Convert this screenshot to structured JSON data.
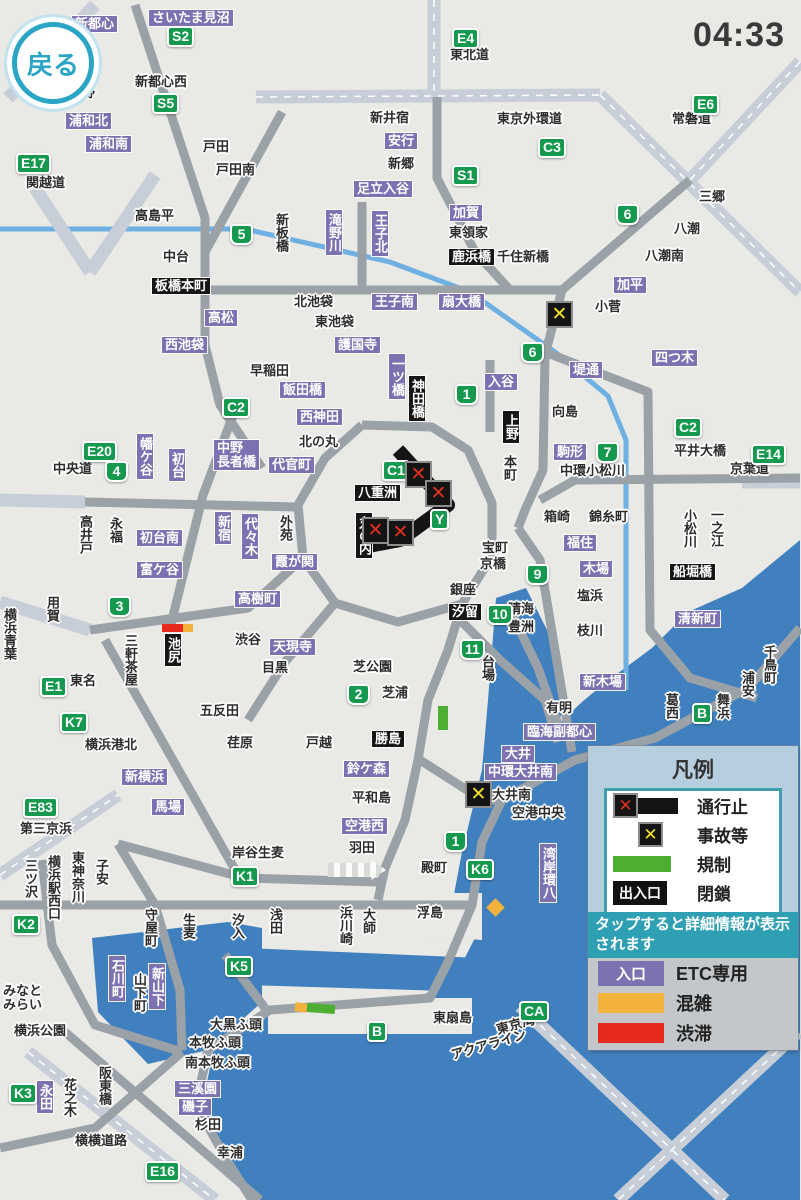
{
  "app": {
    "back_label": "戻る",
    "time": "04:33"
  },
  "colors": {
    "water": "#4180be",
    "land": "#e9e9e5",
    "road": "#9aa1a7",
    "road_light": "#c7ced8",
    "river": "#6fb0e2",
    "entrance": "#7e71b2",
    "route_badge": "#15994f",
    "jam": "#e62b1e",
    "congestion": "#f2b23c",
    "regulation": "#4caf32",
    "closed_road": "#141414"
  },
  "legend": {
    "title": "凡例",
    "rows": [
      {
        "sym": "closure",
        "label": "通行止"
      },
      {
        "sym": "accident",
        "label": "事故等"
      },
      {
        "sym": "regulation",
        "label": "規制"
      },
      {
        "sym": "gate",
        "badge": "出入口",
        "label": "閉鎖"
      }
    ],
    "note": "タップすると詳細情報が表示されます",
    "rows2": [
      {
        "sym": "entrance",
        "badge": "入口",
        "label": "ETC専用"
      },
      {
        "sym": "congestion",
        "label": "混雑"
      },
      {
        "sym": "jam",
        "label": "渋滞"
      }
    ]
  },
  "map": {
    "labels": [
      {
        "t": "さいたま見沼",
        "k": "e",
        "x": 149,
        "y": 10
      },
      {
        "t": "新都心",
        "k": "e",
        "x": 72,
        "y": 16
      },
      {
        "t": "S2",
        "k": "r",
        "x": 167,
        "y": 26
      },
      {
        "t": "野",
        "k": "p",
        "x": 82,
        "y": 86
      },
      {
        "t": "新都心西",
        "k": "p",
        "x": 135,
        "y": 75
      },
      {
        "t": "S5",
        "k": "r",
        "x": 152,
        "y": 93
      },
      {
        "t": "浦和北",
        "k": "e",
        "x": 66,
        "y": 113
      },
      {
        "t": "浦和南",
        "k": "e",
        "x": 86,
        "y": 136
      },
      {
        "t": "E17",
        "k": "r",
        "x": 16,
        "y": 153
      },
      {
        "t": "関越道",
        "k": "p",
        "x": 26,
        "y": 176
      },
      {
        "t": "戸田",
        "k": "p",
        "x": 203,
        "y": 140
      },
      {
        "t": "戸田南",
        "k": "p",
        "x": 216,
        "y": 163
      },
      {
        "t": "E4",
        "k": "r",
        "x": 452,
        "y": 28
      },
      {
        "t": "東北道",
        "k": "p",
        "x": 450,
        "y": 48
      },
      {
        "t": "新井宿",
        "k": "p",
        "x": 370,
        "y": 111
      },
      {
        "t": "安行",
        "k": "e",
        "x": 385,
        "y": 133
      },
      {
        "t": "新郷",
        "k": "p",
        "x": 388,
        "y": 157
      },
      {
        "t": "足立入谷",
        "k": "e",
        "x": 354,
        "y": 181
      },
      {
        "t": "東京外環道",
        "k": "p",
        "x": 497,
        "y": 112
      },
      {
        "t": "C3",
        "k": "r",
        "x": 538,
        "y": 137
      },
      {
        "t": "E6",
        "k": "r",
        "x": 692,
        "y": 94
      },
      {
        "t": "常磐道",
        "k": "p",
        "x": 672,
        "y": 112
      },
      {
        "t": "S1",
        "k": "r",
        "x": 452,
        "y": 165
      },
      {
        "t": "三郷",
        "k": "p",
        "x": 699,
        "y": 190
      },
      {
        "t": "高島平",
        "k": "p",
        "x": 135,
        "y": 209
      },
      {
        "t": "中台",
        "k": "p",
        "x": 163,
        "y": 250
      },
      {
        "t": "5",
        "k": "n",
        "x": 230,
        "y": 224
      },
      {
        "t": "加賀",
        "k": "e",
        "x": 450,
        "y": 205
      },
      {
        "t": "東領家",
        "k": "p",
        "x": 449,
        "y": 226
      },
      {
        "t": "鹿浜橋",
        "k": "f",
        "x": 449,
        "y": 249
      },
      {
        "t": "千住新橋",
        "k": "p",
        "x": 497,
        "y": 250
      },
      {
        "t": "八潮",
        "k": "p",
        "x": 674,
        "y": 222
      },
      {
        "t": "八潮南",
        "k": "p",
        "x": 645,
        "y": 249
      },
      {
        "t": "6",
        "k": "n",
        "x": 616,
        "y": 204
      },
      {
        "t": "加平",
        "k": "e",
        "x": 614,
        "y": 277
      },
      {
        "t": "小菅",
        "k": "p",
        "x": 595,
        "y": 300
      },
      {
        "t": "新板橋",
        "k": "pv",
        "x": 274,
        "y": 213
      },
      {
        "t": "滝野川",
        "k": "ev",
        "x": 326,
        "y": 210
      },
      {
        "t": "王子北",
        "k": "ev",
        "x": 372,
        "y": 211
      },
      {
        "t": "板橋本町",
        "k": "f",
        "x": 152,
        "y": 278
      },
      {
        "t": "北池袋",
        "k": "p",
        "x": 294,
        "y": 295
      },
      {
        "t": "王子南",
        "k": "e",
        "x": 372,
        "y": 294
      },
      {
        "t": "扇大橋",
        "k": "e",
        "x": 439,
        "y": 294
      },
      {
        "t": "高松",
        "k": "e",
        "x": 205,
        "y": 310
      },
      {
        "t": "西池袋",
        "k": "e",
        "x": 162,
        "y": 337
      },
      {
        "t": "東池袋",
        "k": "p",
        "x": 315,
        "y": 315
      },
      {
        "t": "護国寺",
        "k": "e",
        "x": 335,
        "y": 337
      },
      {
        "t": "四つ木",
        "k": "e",
        "x": 652,
        "y": 350
      },
      {
        "t": "堤通",
        "k": "e",
        "x": 570,
        "y": 362
      },
      {
        "t": "6",
        "k": "n",
        "x": 521,
        "y": 342
      },
      {
        "t": "早稲田",
        "k": "p",
        "x": 250,
        "y": 364
      },
      {
        "t": "飯田橋",
        "k": "e",
        "x": 280,
        "y": 382
      },
      {
        "t": "西神田",
        "k": "e",
        "x": 297,
        "y": 409
      },
      {
        "t": "一ツ橋",
        "k": "ev",
        "x": 389,
        "y": 354
      },
      {
        "t": "神田橋",
        "k": "fv",
        "x": 409,
        "y": 376
      },
      {
        "t": "入谷",
        "k": "e",
        "x": 485,
        "y": 374
      },
      {
        "t": "1",
        "k": "n",
        "x": 455,
        "y": 384
      },
      {
        "t": "上野",
        "k": "fv",
        "x": 503,
        "y": 411
      },
      {
        "t": "本町",
        "k": "pv",
        "x": 502,
        "y": 455
      },
      {
        "t": "向島",
        "k": "p",
        "x": 552,
        "y": 405
      },
      {
        "t": "C2",
        "k": "r",
        "x": 222,
        "y": 397
      },
      {
        "t": "中野\n長者橋",
        "k": "e",
        "x": 214,
        "y": 440
      },
      {
        "t": "幡ケ谷",
        "k": "ev",
        "x": 137,
        "y": 434
      },
      {
        "t": "初台",
        "k": "ev",
        "x": 169,
        "y": 449
      },
      {
        "t": "E20",
        "k": "r",
        "x": 82,
        "y": 441
      },
      {
        "t": "中央道",
        "k": "p",
        "x": 53,
        "y": 462
      },
      {
        "t": "4",
        "k": "n",
        "x": 105,
        "y": 461
      },
      {
        "t": "北の丸",
        "k": "p",
        "x": 299,
        "y": 435
      },
      {
        "t": "代官町",
        "k": "e",
        "x": 269,
        "y": 457
      },
      {
        "t": "C1",
        "k": "r",
        "x": 382,
        "y": 460
      },
      {
        "t": "八重洲",
        "k": "f",
        "x": 355,
        "y": 485
      },
      {
        "t": "Y",
        "k": "r",
        "x": 430,
        "y": 509
      },
      {
        "t": "丸の内",
        "k": "fv",
        "x": 356,
        "y": 513
      },
      {
        "t": "駒形",
        "k": "e",
        "x": 554,
        "y": 444
      },
      {
        "t": "7",
        "k": "n",
        "x": 596,
        "y": 442
      },
      {
        "t": "中環小松川",
        "k": "p",
        "x": 560,
        "y": 464
      },
      {
        "t": "C2",
        "k": "r",
        "x": 674,
        "y": 417
      },
      {
        "t": "平井大橋",
        "k": "p",
        "x": 674,
        "y": 444
      },
      {
        "t": "E14",
        "k": "r",
        "x": 751,
        "y": 444
      },
      {
        "t": "京葉道",
        "k": "p",
        "x": 730,
        "y": 462
      },
      {
        "t": "高井戸",
        "k": "pv",
        "x": 78,
        "y": 515
      },
      {
        "t": "永福",
        "k": "pv",
        "x": 108,
        "y": 517
      },
      {
        "t": "新宿",
        "k": "ev",
        "x": 215,
        "y": 512
      },
      {
        "t": "代々木",
        "k": "ev",
        "x": 242,
        "y": 514
      },
      {
        "t": "初台南",
        "k": "e",
        "x": 137,
        "y": 530
      },
      {
        "t": "富ケ谷",
        "k": "e",
        "x": 137,
        "y": 562
      },
      {
        "t": "外苑",
        "k": "pv",
        "x": 278,
        "y": 515
      },
      {
        "t": "霞が関",
        "k": "e",
        "x": 272,
        "y": 554
      },
      {
        "t": "箱崎",
        "k": "p",
        "x": 544,
        "y": 510
      },
      {
        "t": "錦糸町",
        "k": "p",
        "x": 589,
        "y": 510
      },
      {
        "t": "小松川",
        "k": "pv",
        "x": 682,
        "y": 509
      },
      {
        "t": "一之江",
        "k": "pv",
        "x": 709,
        "y": 508
      },
      {
        "t": "船堀橋",
        "k": "f",
        "x": 670,
        "y": 564
      },
      {
        "t": "福住",
        "k": "e",
        "x": 564,
        "y": 535
      },
      {
        "t": "木場",
        "k": "e",
        "x": 580,
        "y": 561
      },
      {
        "t": "塩浜",
        "k": "p",
        "x": 577,
        "y": 589
      },
      {
        "t": "枝川",
        "k": "p",
        "x": 577,
        "y": 624
      },
      {
        "t": "宝町",
        "k": "p",
        "x": 482,
        "y": 541
      },
      {
        "t": "京橋",
        "k": "p",
        "x": 480,
        "y": 557
      },
      {
        "t": "銀座",
        "k": "p",
        "x": 450,
        "y": 583
      },
      {
        "t": "9",
        "k": "n",
        "x": 526,
        "y": 564
      },
      {
        "t": "汐留",
        "k": "f",
        "x": 449,
        "y": 604
      },
      {
        "t": "10",
        "k": "n",
        "x": 487,
        "y": 604
      },
      {
        "t": "晴海",
        "k": "p",
        "x": 508,
        "y": 602
      },
      {
        "t": "豊洲",
        "k": "p",
        "x": 508,
        "y": 620
      },
      {
        "t": "11",
        "k": "n",
        "x": 460,
        "y": 639
      },
      {
        "t": "台場",
        "k": "pv",
        "x": 480,
        "y": 655
      },
      {
        "t": "高樹町",
        "k": "e",
        "x": 235,
        "y": 591
      },
      {
        "t": "渋谷",
        "k": "p",
        "x": 235,
        "y": 633
      },
      {
        "t": "天現寺",
        "k": "e",
        "x": 270,
        "y": 639
      },
      {
        "t": "目黒",
        "k": "p",
        "x": 262,
        "y": 661
      },
      {
        "t": "池尻",
        "k": "fv",
        "x": 165,
        "y": 634
      },
      {
        "t": "3",
        "k": "n",
        "x": 108,
        "y": 596
      },
      {
        "t": "用賀",
        "k": "pv",
        "x": 45,
        "y": 596
      },
      {
        "t": "横浜青葉",
        "k": "pv",
        "x": 2,
        "y": 608
      },
      {
        "t": "三軒茶屋",
        "k": "pv",
        "x": 123,
        "y": 634
      },
      {
        "t": "E1",
        "k": "r",
        "x": 40,
        "y": 676
      },
      {
        "t": "東名",
        "k": "p",
        "x": 70,
        "y": 674
      },
      {
        "t": "五反田",
        "k": "p",
        "x": 200,
        "y": 704
      },
      {
        "t": "荏原",
        "k": "p",
        "x": 227,
        "y": 736
      },
      {
        "t": "芝公園",
        "k": "p",
        "x": 353,
        "y": 660
      },
      {
        "t": "2",
        "k": "n",
        "x": 347,
        "y": 684
      },
      {
        "t": "芝浦",
        "k": "p",
        "x": 382,
        "y": 686
      },
      {
        "t": "戸越",
        "k": "p",
        "x": 306,
        "y": 736
      },
      {
        "t": "勝島",
        "k": "f",
        "x": 372,
        "y": 731
      },
      {
        "t": "鈴ケ森",
        "k": "e",
        "x": 344,
        "y": 761
      },
      {
        "t": "K7",
        "k": "r",
        "x": 60,
        "y": 712
      },
      {
        "t": "横浜港北",
        "k": "p",
        "x": 85,
        "y": 738
      },
      {
        "t": "新横浜",
        "k": "e",
        "x": 122,
        "y": 769
      },
      {
        "t": "馬場",
        "k": "e",
        "x": 152,
        "y": 799
      },
      {
        "t": "E83",
        "k": "r",
        "x": 23,
        "y": 797
      },
      {
        "t": "第三京浜",
        "k": "p",
        "x": 20,
        "y": 822
      },
      {
        "t": "新木場",
        "k": "e",
        "x": 580,
        "y": 674
      },
      {
        "t": "有明",
        "k": "p",
        "x": 546,
        "y": 701
      },
      {
        "t": "臨海副都心",
        "k": "e",
        "x": 524,
        "y": 724
      },
      {
        "t": "葛西",
        "k": "pv",
        "x": 664,
        "y": 693
      },
      {
        "t": "B",
        "k": "r",
        "x": 692,
        "y": 703
      },
      {
        "t": "舞浜",
        "k": "pv",
        "x": 715,
        "y": 693
      },
      {
        "t": "浦安",
        "k": "pv",
        "x": 740,
        "y": 671
      },
      {
        "t": "千鳥町",
        "k": "pv",
        "x": 762,
        "y": 645
      },
      {
        "t": "清新町",
        "k": "e",
        "x": 675,
        "y": 611
      },
      {
        "t": "大井",
        "k": "e",
        "x": 502,
        "y": 746
      },
      {
        "t": "中環大井南",
        "k": "e",
        "x": 485,
        "y": 764
      },
      {
        "t": "大井南",
        "k": "p",
        "x": 492,
        "y": 788
      },
      {
        "t": "空港中央",
        "k": "p",
        "x": 512,
        "y": 806
      },
      {
        "t": "平和島",
        "k": "p",
        "x": 352,
        "y": 791
      },
      {
        "t": "空港西",
        "k": "e",
        "x": 342,
        "y": 818
      },
      {
        "t": "羽田",
        "k": "p",
        "x": 349,
        "y": 841
      },
      {
        "t": "1",
        "k": "n",
        "x": 444,
        "y": 831
      },
      {
        "t": "殿町",
        "k": "p",
        "x": 421,
        "y": 861
      },
      {
        "t": "K6",
        "k": "r",
        "x": 466,
        "y": 859
      },
      {
        "t": "湾岸環八",
        "k": "ev",
        "x": 540,
        "y": 844
      },
      {
        "t": "岸谷生麦",
        "k": "p",
        "x": 232,
        "y": 846
      },
      {
        "t": "K1",
        "k": "r",
        "x": 231,
        "y": 866
      },
      {
        "t": "浮島",
        "k": "p",
        "x": 417,
        "y": 906
      },
      {
        "t": "浅田",
        "k": "pv",
        "x": 268,
        "y": 908
      },
      {
        "t": "浜川崎",
        "k": "pv",
        "x": 338,
        "y": 906
      },
      {
        "t": "大師",
        "k": "pv",
        "x": 361,
        "y": 908
      },
      {
        "t": "三ツ沢",
        "k": "pv",
        "x": 23,
        "y": 859
      },
      {
        "t": "横浜駅西口",
        "k": "pv",
        "x": 46,
        "y": 855
      },
      {
        "t": "東神奈川",
        "k": "pv",
        "x": 70,
        "y": 851
      },
      {
        "t": "子安",
        "k": "pv",
        "x": 94,
        "y": 859
      },
      {
        "t": "K2",
        "k": "r",
        "x": 12,
        "y": 914
      },
      {
        "t": "守屋町",
        "k": "pv",
        "x": 143,
        "y": 908
      },
      {
        "t": "生麦",
        "k": "pv",
        "x": 181,
        "y": 913
      },
      {
        "t": "汐入",
        "k": "pv",
        "x": 230,
        "y": 913
      },
      {
        "t": "K5",
        "k": "r",
        "x": 225,
        "y": 956
      },
      {
        "t": "石川町",
        "k": "ev",
        "x": 109,
        "y": 956
      },
      {
        "t": "山下町",
        "k": "pv",
        "x": 132,
        "y": 973
      },
      {
        "t": "新山下",
        "k": "ev",
        "x": 149,
        "y": 964
      },
      {
        "t": "みなと\nみらい",
        "k": "p",
        "x": 3,
        "y": 984
      },
      {
        "t": "横浜公園",
        "k": "p",
        "x": 14,
        "y": 1024
      },
      {
        "t": "K3",
        "k": "r",
        "x": 9,
        "y": 1083
      },
      {
        "t": "永田",
        "k": "ev",
        "x": 37,
        "y": 1081
      },
      {
        "t": "花之木",
        "k": "pv",
        "x": 62,
        "y": 1078
      },
      {
        "t": "阪東橋",
        "k": "pv",
        "x": 97,
        "y": 1066
      },
      {
        "t": "横横道路",
        "k": "p",
        "x": 75,
        "y": 1134
      },
      {
        "t": "E16",
        "k": "r",
        "x": 145,
        "y": 1161
      },
      {
        "t": "大黒ふ頭",
        "k": "p",
        "x": 210,
        "y": 1018
      },
      {
        "t": "本牧ふ頭",
        "k": "p",
        "x": 189,
        "y": 1036
      },
      {
        "t": "南本牧ふ頭",
        "k": "p",
        "x": 185,
        "y": 1056
      },
      {
        "t": "三溪園",
        "k": "e",
        "x": 175,
        "y": 1081
      },
      {
        "t": "磯子",
        "k": "e",
        "x": 179,
        "y": 1099
      },
      {
        "t": "杉田",
        "k": "p",
        "x": 195,
        "y": 1118
      },
      {
        "t": "幸浦",
        "k": "p",
        "x": 217,
        "y": 1146
      },
      {
        "t": "B",
        "k": "r",
        "x": 367,
        "y": 1021
      },
      {
        "t": "東扇島",
        "k": "p",
        "x": 433,
        "y": 1011
      },
      {
        "t": "CA",
        "k": "r",
        "x": 519,
        "y": 1001
      },
      {
        "t": "東京湾",
        "k": "pr",
        "x": 496,
        "y": 1018
      },
      {
        "t": "アクアライン",
        "k": "pr",
        "x": 450,
        "y": 1038
      }
    ],
    "markers": [
      {
        "type": "closure",
        "x": 405,
        "y": 461
      },
      {
        "type": "closure",
        "x": 425,
        "y": 480
      },
      {
        "type": "closure",
        "x": 362,
        "y": 517
      },
      {
        "type": "closure",
        "x": 387,
        "y": 519
      },
      {
        "type": "accident",
        "x": 546,
        "y": 301
      },
      {
        "type": "accident",
        "x": 465,
        "y": 781
      }
    ],
    "segments": [
      {
        "c": "jam",
        "x": 162,
        "y": 624,
        "w": 21,
        "h": 8,
        "rot": 0
      },
      {
        "c": "congestion",
        "x": 183,
        "y": 624,
        "w": 10,
        "h": 8,
        "rot": 0
      },
      {
        "c": "regulation",
        "x": 438,
        "y": 706,
        "w": 10,
        "h": 24,
        "rot": 0
      },
      {
        "c": "congestion",
        "x": 489,
        "y": 901,
        "w": 13,
        "h": 13,
        "rot": 45
      },
      {
        "c": "congestion",
        "x": 295,
        "y": 1003,
        "w": 12,
        "h": 9,
        "rot": 8
      },
      {
        "c": "regulation",
        "x": 307,
        "y": 1004,
        "w": 28,
        "h": 9,
        "rot": 4
      }
    ]
  }
}
